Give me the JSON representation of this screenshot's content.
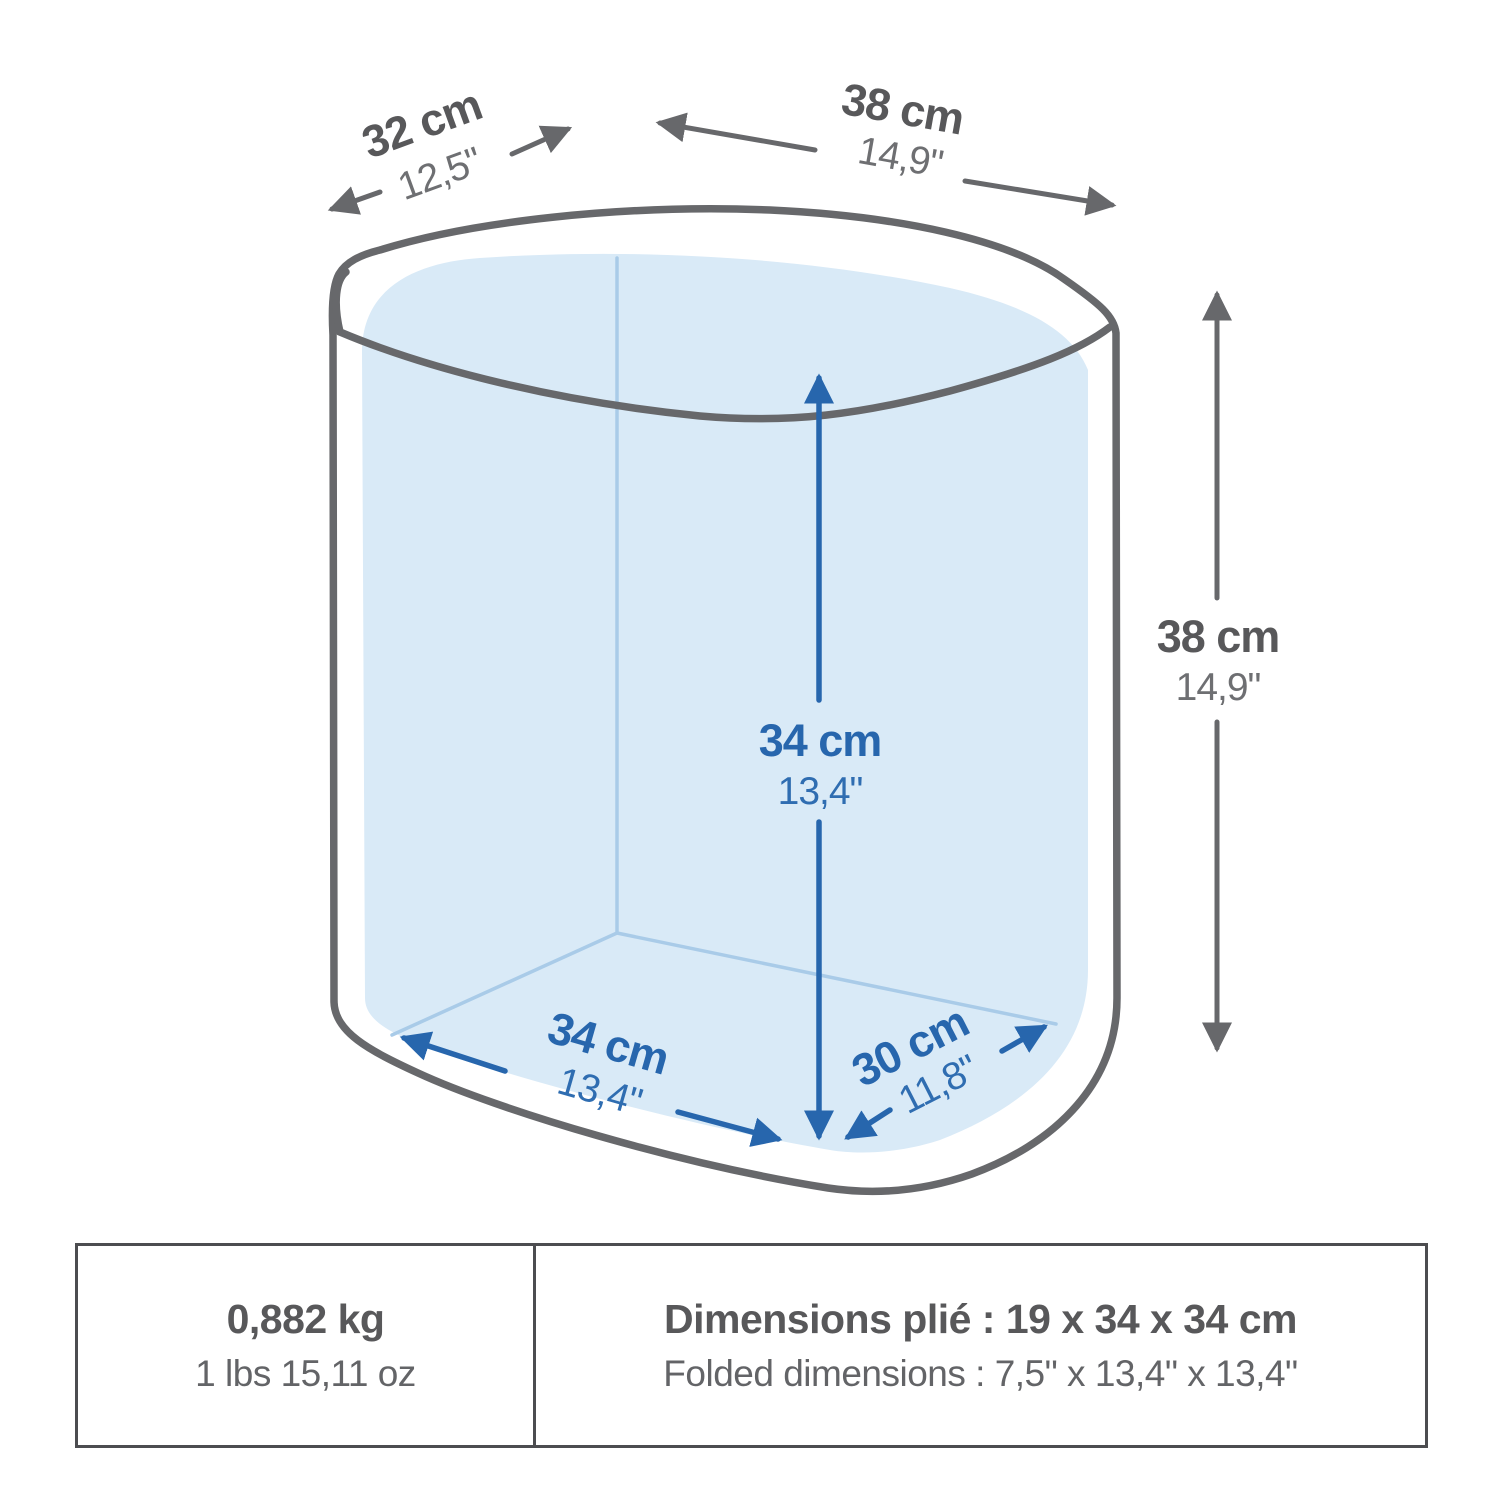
{
  "diagram": {
    "dims": {
      "top_width": {
        "cm": "32 cm",
        "inch": "12,5\""
      },
      "top_depth": {
        "cm": "38 cm",
        "inch": "14,9\""
      },
      "outer_height": {
        "cm": "38 cm",
        "inch": "14,9\""
      },
      "inner_height": {
        "cm": "34 cm",
        "inch": "13,4\""
      },
      "bottom_width": {
        "cm": "34 cm",
        "inch": "13,4\""
      },
      "bottom_depth": {
        "cm": "30 cm",
        "inch": "11,8\""
      }
    },
    "colors": {
      "outline_gray": "#67686b",
      "label_gray": "#58585a",
      "label_gray_light": "#6e6f72",
      "dimension_blue": "#2766ad",
      "interior_fill": "#d9eaf7",
      "interior_edge": "#a9cbe8",
      "table_border": "#4c4d50"
    }
  },
  "info_table": {
    "weight": {
      "primary": "0,882 kg",
      "secondary": "1 lbs 15,11 oz"
    },
    "folded": {
      "primary": "Dimensions plié : 19 x 34 x 34 cm",
      "secondary": "Folded dimensions : 7,5\" x 13,4\" x 13,4\""
    }
  }
}
